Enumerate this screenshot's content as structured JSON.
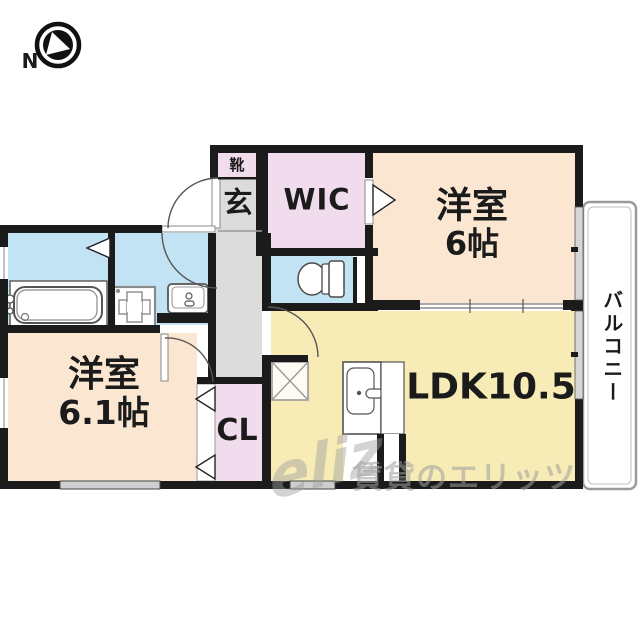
{
  "compass": {
    "direction_label": "N"
  },
  "rooms": {
    "entrance": {
      "shoe_cabinet_label": "靴",
      "label": "玄"
    },
    "walk_in_closet": {
      "label": "WIC"
    },
    "bedroom_upper": {
      "name": "洋室",
      "size": "6帖"
    },
    "bedroom_lower": {
      "name": "洋室",
      "size": "6.1帖"
    },
    "ldk": {
      "label": "LDK10.5"
    },
    "closet": {
      "label": "CL"
    },
    "balcony": {
      "label": "バルコニー"
    }
  },
  "watermark": {
    "logo_text": "eliz",
    "text": "賃貸のエリッツ"
  },
  "colors": {
    "wall": "#1b1b1b",
    "room_peach": "#fbe6d1",
    "room_yellow": "#f8ecb6",
    "room_pink": "#f0dcec",
    "room_blue": "#c2e3f3",
    "floor_gray": "#dcdcdc",
    "watermark_gray": "#9e9e9e"
  }
}
